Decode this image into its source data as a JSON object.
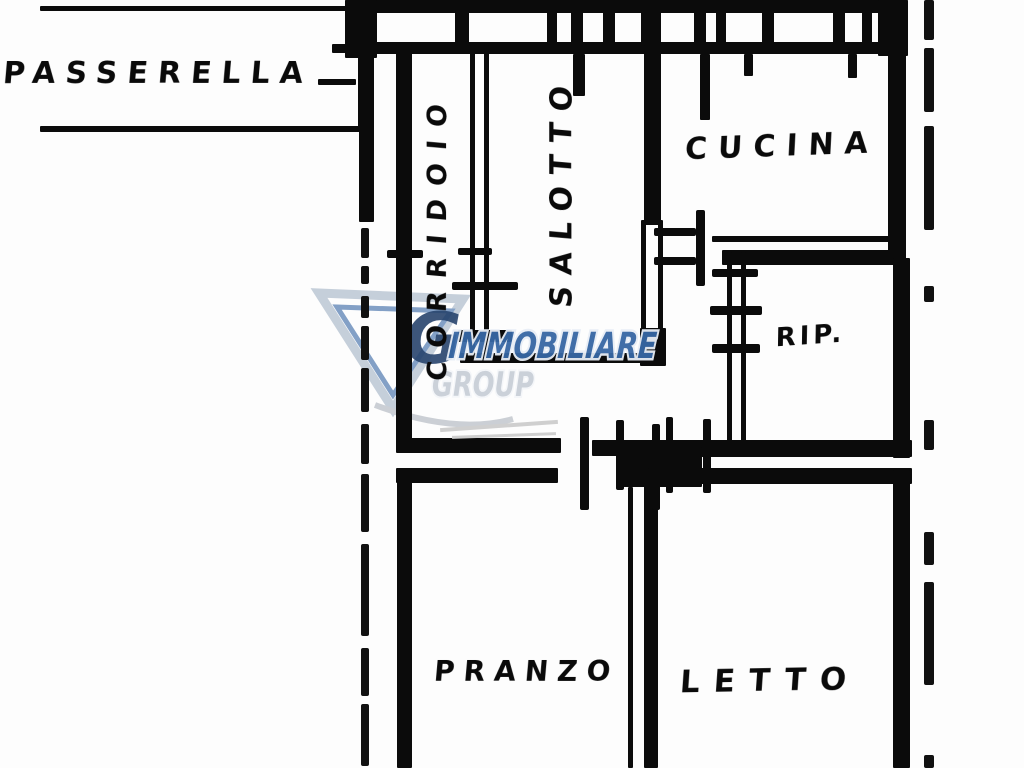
{
  "page": {
    "title": "Planimetria (floor plan)",
    "background": "#fdfdfd",
    "ink_color": "#0b0b0b"
  },
  "watermark": {
    "line1": "IMMOBILIARE",
    "line2": "GROUP",
    "logo_letter": "G",
    "line1_color": "#3767a4",
    "line2_color": "#c9cfd8",
    "outline_color": "#eef3f9",
    "triangle_outer_color": "#c3cdd9",
    "triangle_inner_color": "#7d9cc4",
    "logo_letter_color": "#1d3b66"
  },
  "labels": [
    {
      "id": "passerella",
      "text": "PASSERELLA",
      "type": "h",
      "x": 2,
      "y": 57,
      "w": 312,
      "fs": 30,
      "ls": 10,
      "rot": 0
    },
    {
      "id": "corridoio",
      "text": "CORRIDOIO",
      "type": "v",
      "cx": 438,
      "cy": 247,
      "len": 278,
      "fs": 27,
      "ls": 13,
      "rot": -90
    },
    {
      "id": "salotto",
      "text": "SALOTTO",
      "type": "v",
      "cx": 562,
      "cy": 212,
      "len": 202,
      "fs": 30,
      "ls": 11,
      "rot": -90
    },
    {
      "id": "cucina",
      "text": "CUCINA",
      "type": "h",
      "x": 685,
      "y": 130,
      "w": 185,
      "fs": 30,
      "ls": 11,
      "rot": -2
    },
    {
      "id": "rip",
      "text": "RIP.",
      "type": "h",
      "x": 768,
      "y": 322,
      "w": 85,
      "fs": 26,
      "ls": 4,
      "rot": -4
    },
    {
      "id": "pranzo",
      "text": "PRANZO",
      "type": "h",
      "x": 434,
      "y": 657,
      "w": 160,
      "fs": 28,
      "ls": 9,
      "rot": 0
    },
    {
      "id": "letto",
      "text": "LETTO",
      "type": "h",
      "x": 680,
      "y": 664,
      "w": 168,
      "fs": 31,
      "ls": 14,
      "rot": -1
    }
  ],
  "plan": {
    "walls": [
      [
        345,
        0,
        563,
        13
      ],
      [
        352,
        42,
        556,
        12
      ],
      [
        40,
        6,
        307,
        5
      ],
      [
        40,
        126,
        322,
        6
      ],
      [
        318,
        79,
        38,
        6
      ],
      [
        332,
        44,
        32,
        9
      ],
      [
        345,
        0,
        32,
        58
      ],
      [
        358,
        55,
        16,
        76
      ],
      [
        359,
        126,
        15,
        96
      ],
      [
        396,
        45,
        16,
        400
      ],
      [
        396,
        438,
        165,
        15
      ],
      [
        396,
        468,
        162,
        15
      ],
      [
        397,
        468,
        15,
        300
      ],
      [
        470,
        45,
        5,
        312
      ],
      [
        484,
        45,
        5,
        312
      ],
      [
        458,
        330,
        54,
        12
      ],
      [
        460,
        353,
        202,
        10
      ],
      [
        644,
        45,
        17,
        180
      ],
      [
        641,
        220,
        5,
        112
      ],
      [
        658,
        220,
        5,
        112
      ],
      [
        640,
        328,
        26,
        38
      ],
      [
        888,
        42,
        18,
        212
      ],
      [
        712,
        236,
        192,
        6
      ],
      [
        722,
        250,
        184,
        15
      ],
      [
        727,
        252,
        5,
        198
      ],
      [
        741,
        252,
        5,
        198
      ],
      [
        893,
        258,
        17,
        200
      ],
      [
        700,
        440,
        212,
        17
      ],
      [
        592,
        440,
        112,
        16
      ],
      [
        617,
        447,
        85,
        40
      ],
      [
        648,
        468,
        264,
        16
      ],
      [
        893,
        470,
        17,
        298
      ],
      [
        628,
        487,
        5,
        281
      ],
      [
        644,
        483,
        14,
        285
      ],
      [
        455,
        10,
        14,
        34
      ],
      [
        547,
        10,
        10,
        34
      ],
      [
        571,
        10,
        12,
        34
      ],
      [
        603,
        10,
        12,
        34
      ],
      [
        641,
        10,
        20,
        34
      ],
      [
        694,
        10,
        12,
        34
      ],
      [
        716,
        10,
        10,
        34
      ],
      [
        762,
        10,
        12,
        34
      ],
      [
        833,
        10,
        12,
        34
      ],
      [
        862,
        10,
        10,
        34
      ],
      [
        878,
        0,
        30,
        56
      ],
      [
        573,
        54,
        12,
        42
      ],
      [
        700,
        54,
        10,
        66
      ],
      [
        744,
        54,
        9,
        22
      ],
      [
        848,
        54,
        9,
        24
      ]
    ],
    "dashes": [
      [
        361,
        228,
        8,
        30
      ],
      [
        361,
        266,
        8,
        18
      ],
      [
        361,
        296,
        8,
        22
      ],
      [
        361,
        326,
        8,
        34
      ],
      [
        361,
        368,
        8,
        44
      ],
      [
        361,
        424,
        8,
        40
      ],
      [
        361,
        474,
        8,
        58
      ],
      [
        361,
        544,
        8,
        92
      ],
      [
        361,
        648,
        8,
        48
      ],
      [
        361,
        704,
        8,
        62
      ],
      [
        924,
        0,
        10,
        40
      ],
      [
        924,
        48,
        10,
        64
      ],
      [
        924,
        126,
        10,
        104
      ],
      [
        924,
        286,
        10,
        16
      ],
      [
        924,
        420,
        10,
        30
      ],
      [
        924,
        532,
        10,
        33
      ],
      [
        924,
        582,
        10,
        103
      ],
      [
        924,
        755,
        10,
        13
      ]
    ],
    "door_ticks": [
      [
        458,
        248,
        34,
        7
      ],
      [
        452,
        282,
        66,
        8
      ],
      [
        387,
        250,
        36,
        8
      ],
      [
        654,
        228,
        42,
        8
      ],
      [
        654,
        257,
        42,
        8
      ],
      [
        696,
        210,
        9,
        76
      ],
      [
        712,
        269,
        46,
        8
      ],
      [
        710,
        306,
        52,
        9
      ],
      [
        712,
        344,
        48,
        9
      ],
      [
        580,
        417,
        9,
        93
      ],
      [
        616,
        420,
        8,
        70
      ],
      [
        652,
        424,
        8,
        86
      ],
      [
        666,
        417,
        7,
        76
      ],
      [
        703,
        419,
        8,
        74
      ]
    ],
    "gray_marks": [
      [
        440,
        424,
        118,
        4,
        -4
      ],
      [
        452,
        434,
        104,
        3,
        -2
      ]
    ]
  }
}
